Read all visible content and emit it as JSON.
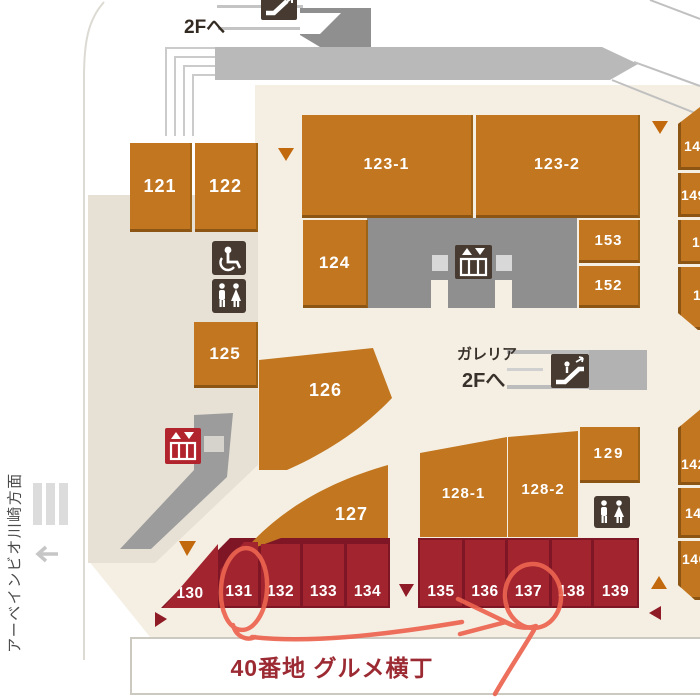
{
  "labels": {
    "upper_escalator_dest": "2Fへ",
    "galleria_name": "ガレリア",
    "galleria_dest": "2Fへ",
    "bottom_area": "40番地 グルメ横丁",
    "left_direction": "アーベインビオ川崎方面"
  },
  "blocks": {
    "orange": [
      "121",
      "122",
      "123-1",
      "123-2",
      "124",
      "153",
      "152",
      "125",
      "126",
      "127",
      "128-1",
      "128-2",
      "129"
    ],
    "red": [
      "130",
      "131",
      "132",
      "133",
      "134",
      "135",
      "136",
      "137",
      "138",
      "139"
    ],
    "right_partial": [
      "14",
      "149",
      "1",
      "1",
      "142",
      "14",
      "140"
    ]
  },
  "icons": {
    "top": "escalator-icon",
    "galleria": "escalator-icon",
    "lobby": "elevator-icon",
    "left_red": "elevator-icon",
    "accessible": "wheelchair-icon",
    "restroom_left": "restroom-icon",
    "restroom_right": "restroom-icon"
  },
  "annotation": {
    "circled_units": [
      "131",
      "137"
    ],
    "color": "#ec6450"
  },
  "colors": {
    "orange_block": "#c1761f",
    "red_block": "#a1242f",
    "floor": "#f5efe3",
    "walkway_gray": "#b9b9b9",
    "accent_text": "#9c2a33"
  }
}
